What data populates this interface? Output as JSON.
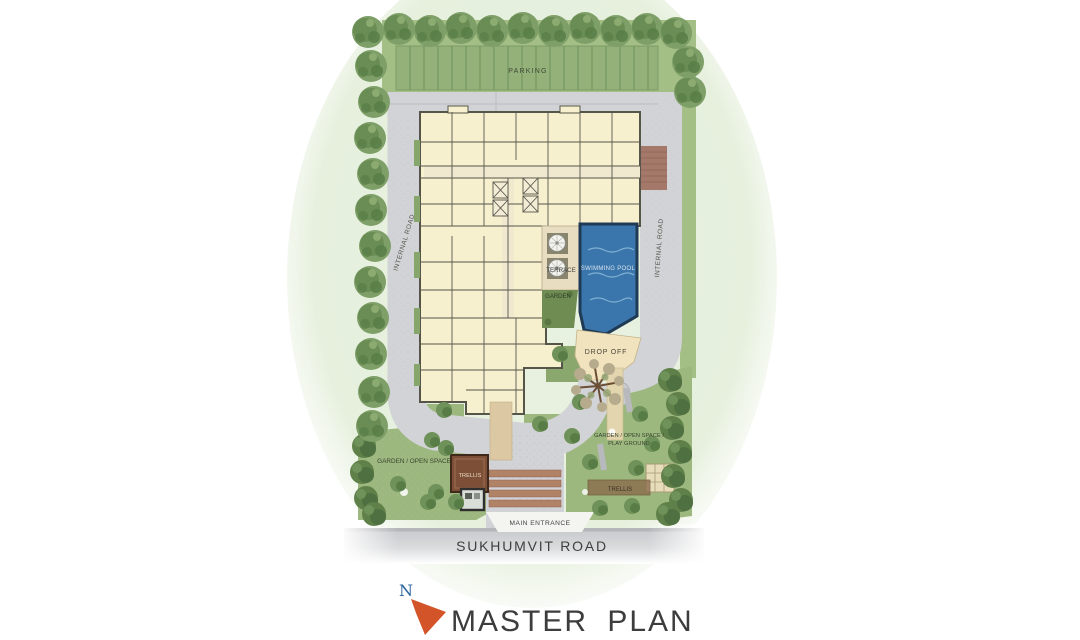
{
  "title": {
    "north_label": "N",
    "plan_title": "MASTER PLAN"
  },
  "labels": {
    "parking": "PARKING",
    "internal_road_left": "INTERNAL ROAD",
    "internal_road_right": "INTERNAL ROAD",
    "terrace": "TERRACE",
    "swimming_pool": "SWIMMING POOL",
    "garden": "GARDEN",
    "drop_off": "DROP OFF",
    "garden_open_space_left": "GARDEN / OPEN SPACE",
    "garden_open_space_right": "GARDEN / OPEN SPACE /",
    "play_ground": "PLAY GROUND",
    "trellis_left": "TRELLIS",
    "trellis_right": "TRELLIS",
    "main_entrance": "MAIN ENTRANCE",
    "sukhumvit_road": "SUKHUMVIT  ROAD"
  },
  "colors": {
    "lawn": "#9cb87e",
    "green_band": "#a4bf85",
    "parking_strip": "#93b178",
    "road": "#d2d3d6",
    "building": "#f7f0cf",
    "building_line": "#55554a",
    "pool": "#3a76ab",
    "pool_border": "#1e3a55",
    "dropoff_cream": "#f0e3bd",
    "terrace_beige": "#e9ddc1",
    "crossing_brown": "#a5796a",
    "steps_brown": "#b08266",
    "trellis_brown": "#7d4f36",
    "tree": "#7e9f68",
    "text_dark": "#3f3f3f",
    "north_blue": "#28639c",
    "arrow_orange": "#d4542a"
  }
}
